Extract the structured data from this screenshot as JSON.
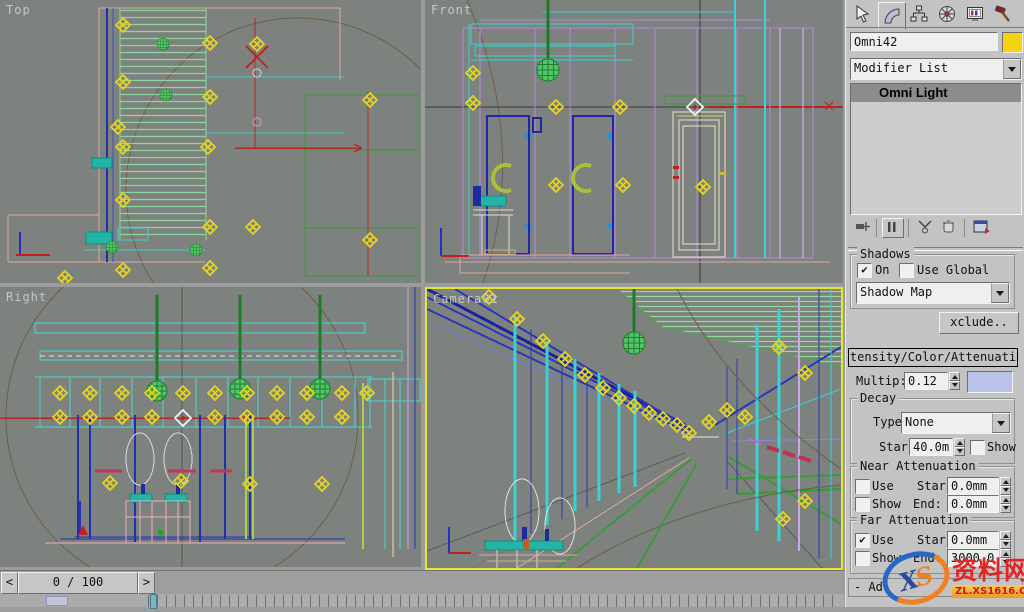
{
  "viewports": {
    "top_label": "Top",
    "front_label": "Front",
    "right_label": "Right",
    "camera_label": "Camera01"
  },
  "timeline": {
    "prev": "<",
    "value": "0 / 100",
    "next": ">"
  },
  "panel": {
    "object_name": "Omni42",
    "object_color": "#f6d30c",
    "modifier_list": "Modifier List",
    "stack_selected": "Omni Light",
    "shadows": {
      "title": "Shadows",
      "on": "On",
      "on_mark": "✔",
      "use_global": "Use Global",
      "use_global_mark": "",
      "map": "Shadow Map",
      "exclude": "xclude.."
    },
    "intensity": {
      "title": "tensity/Color/Attenuati",
      "mult_label": "Multip:",
      "mult_value": "0.12",
      "swatch": "#b9c2e8"
    },
    "decay": {
      "title": "Decay",
      "type_label": "Type",
      "type_value": "None",
      "start_label": "Star",
      "start_value": "40.0m",
      "show": "Show",
      "show_mark": ""
    },
    "near": {
      "title": "Near Attenuation",
      "use": "Use",
      "use_mark": "",
      "show": "Show",
      "show_mark": "",
      "start_label": "Star",
      "start_value": "0.0mm",
      "end_label": "End:",
      "end_value": "0.0mm"
    },
    "far": {
      "title": "Far Attenuation",
      "use": "Use",
      "use_mark": "✔",
      "show": "Show",
      "show_mark": "",
      "start_label": "Star",
      "start_value": "0.0mm",
      "end_label": "End:",
      "end_value": "3000.0"
    },
    "advanced": "- Ad"
  },
  "watermark": {
    "logo_x": "X",
    "logo_s": "S",
    "name": "资料网",
    "url": "ZL.XS1616.COM"
  }
}
